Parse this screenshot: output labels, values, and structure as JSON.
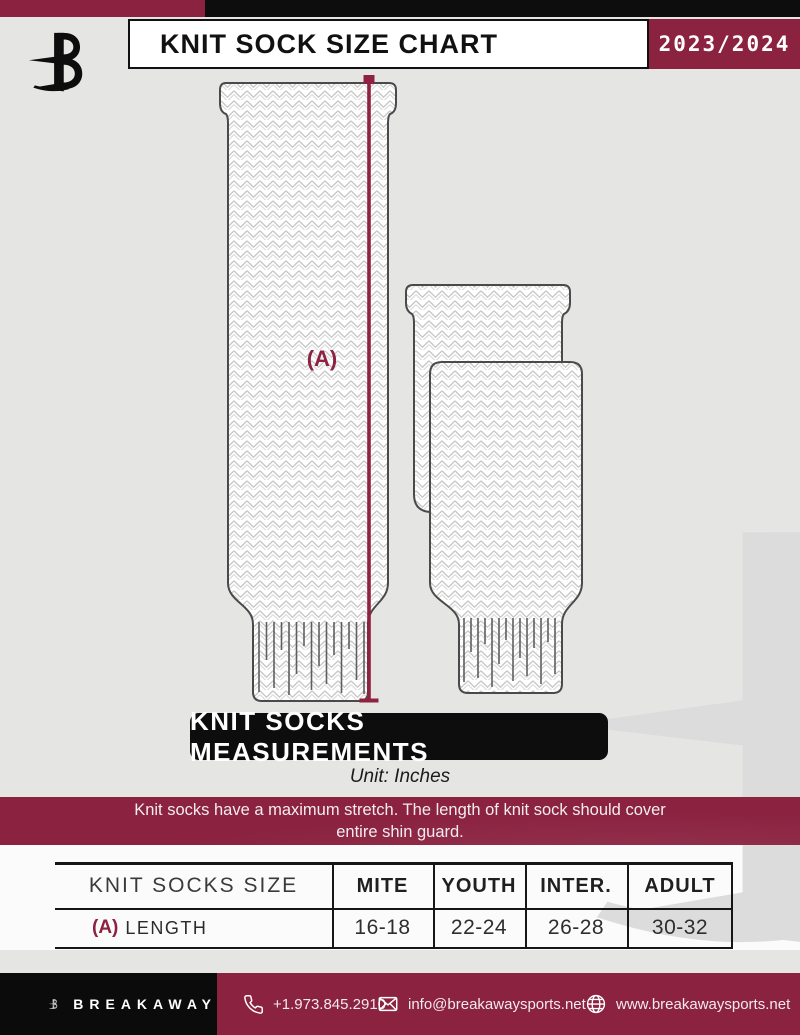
{
  "colors": {
    "accent_maroon": "#8a2240",
    "ink_black": "#0d0d0d",
    "page_gray": "#e5e5e4",
    "knit_outline": "#4a4a4a",
    "knit_pattern": "#c6c6c6",
    "watermark_gray": "#dcdcdc"
  },
  "header": {
    "title": "KNIT SOCK SIZE CHART",
    "season": "2023/2024"
  },
  "diagram": {
    "label_a": "(A)"
  },
  "measurements": {
    "banner": "KNIT SOCKS MEASUREMENTS",
    "unit": "Unit: Inches"
  },
  "notice": {
    "line1": "Knit socks have a maximum stretch. The length of knit sock should cover",
    "line2": "entire shin guard."
  },
  "size_table": {
    "headers": [
      "KNIT SOCKS SIZE",
      "MITE",
      "YOUTH",
      "INTER.",
      "ADULT"
    ],
    "row": {
      "prefix": "(A)",
      "label": "LENGTH",
      "values": [
        "16-18",
        "22-24",
        "26-28",
        "30-32"
      ]
    }
  },
  "footer": {
    "brand": "BREAKAWAY",
    "phone": "+1.973.845.2910",
    "email": "info@breakawaysports.net",
    "website": "www.breakawaysports.net"
  },
  "icons": {
    "phone": "phone-icon",
    "email": "envelope-icon",
    "website": "globe-icon",
    "logo": "breakaway-b-logo"
  }
}
